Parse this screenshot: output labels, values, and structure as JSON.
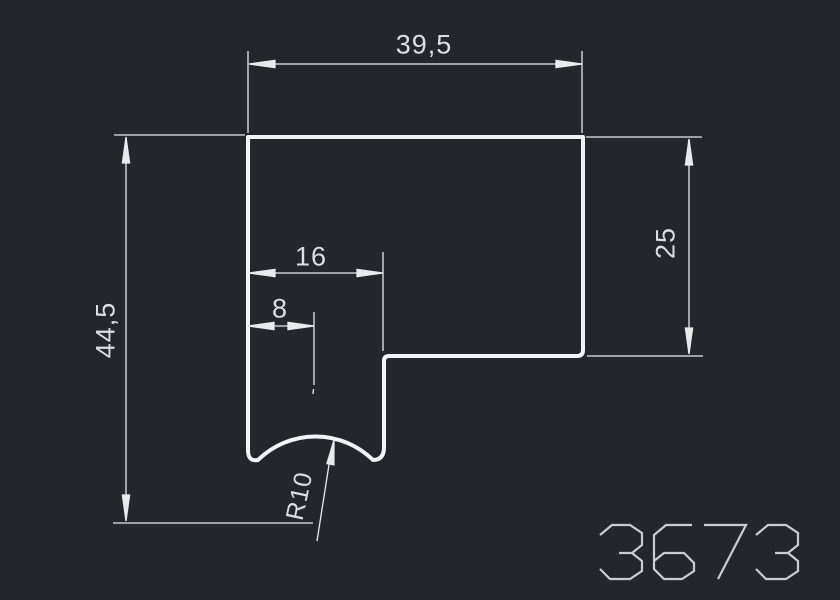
{
  "canvas": {
    "background_color": "#23262b",
    "outline_color": "#f2f4f6",
    "dimension_color": "#e8eaec",
    "text_color": "#dcdfe2",
    "number_color": "#c9cdd2"
  },
  "drawing": {
    "type": "profile-cross-section",
    "labels": {
      "total_width": "39,5",
      "total_height": "44,5",
      "right_height": "25",
      "slot_width": "16",
      "center_offset": "8",
      "groove_radius": "R10"
    },
    "title_block": {
      "number": "3673"
    }
  }
}
